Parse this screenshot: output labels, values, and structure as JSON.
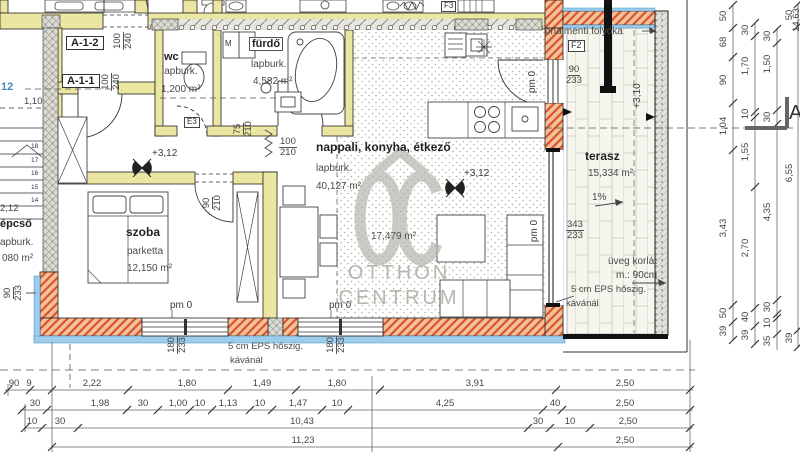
{
  "labels": {
    "a12": "A-1-2",
    "a11": "A-1-1",
    "section": "A",
    "grid12": "12",
    "d110": "1,10",
    "d212": "2,12",
    "cut_right": "14,63"
  },
  "rooms": {
    "wc": {
      "name": "wc",
      "finish": "lapburk.",
      "area": "1,200 m²"
    },
    "furdo": {
      "m": "M",
      "name": "fürdő",
      "finish": "lapburk.",
      "area": "4,582 m²"
    },
    "nappali": {
      "name": "nappali, konyha, étkező",
      "finish": "lapburk.",
      "area": "40,127 m²",
      "sub_area": "17,479 m²"
    },
    "szoba": {
      "name": "szoba",
      "finish": "parketta",
      "area": "12,150 m²"
    },
    "lepcso": {
      "name": "épcső",
      "finish": "apburk.",
      "area": "080 m²",
      "steps": [
        "18",
        "17",
        "16",
        "15",
        "14"
      ]
    },
    "terasz": {
      "name": "terasz",
      "area": "15,334 m²",
      "slope": "1%"
    }
  },
  "levels": {
    "l312": "+3,12",
    "l310": "+3,10",
    "pm0": "pm 0"
  },
  "notes": {
    "folyoka": "onalmenti folyóka",
    "f2": "F2",
    "e3": "E3",
    "f3": "F3",
    "uveg_1": "üveg korlát",
    "uveg_2": "m.: 90cm",
    "eps_1": "5 cm EPS hőszig.",
    "eps_2": "kávánál"
  },
  "openings": {
    "a12": [
      "100",
      "240"
    ],
    "a11": [
      "100",
      "240"
    ],
    "wc": [
      "75",
      "210"
    ],
    "furdo": [
      "100",
      "210"
    ],
    "szoba": [
      "90",
      "210"
    ],
    "west": [
      "90",
      "233"
    ],
    "terasz_door": [
      "90",
      "233"
    ],
    "glazing": [
      "343",
      "233"
    ],
    "win1": [
      "180",
      "233"
    ],
    "win2": [
      "180",
      "233"
    ]
  },
  "watermark": {
    "line1": "OTTHON",
    "line2": "CENTRUM"
  },
  "dims": {
    "bottom": {
      "row1": [
        "90",
        "9",
        "2,22",
        "1,80",
        "1,49",
        "1,80",
        "3,91",
        "2,50"
      ],
      "row2": [
        "30",
        "1,98",
        "30",
        "1,00",
        "10",
        "1,13",
        "10",
        "1,47",
        "10",
        "4,25",
        "40",
        "2,50"
      ],
      "row3": [
        "10",
        "30",
        "10,43",
        "30",
        "10",
        "2,50"
      ],
      "row4": [
        "11,23",
        "2,50"
      ]
    },
    "right": {
      "c1": [
        "50",
        "68",
        "90",
        "1,04",
        "3,43",
        "50",
        "39"
      ],
      "c2": [
        "30",
        "1,70",
        "10",
        "1,55",
        "2,70",
        "40",
        "39"
      ],
      "c3": [
        "30",
        "1,50",
        "30",
        "4,35",
        "30",
        "10",
        "35"
      ],
      "c4": [
        "50",
        "6,55",
        "39"
      ]
    }
  },
  "colors": {
    "wall_fill": "#ece7a2",
    "insulation_hatch": "#d4552a",
    "insulation_bg": "#f6c09a",
    "waterproof_blue": "#9ecdec",
    "concrete": "#dddcd4",
    "watermark": "#b6b6af",
    "grid_text_blue": "#4a86c8"
  }
}
